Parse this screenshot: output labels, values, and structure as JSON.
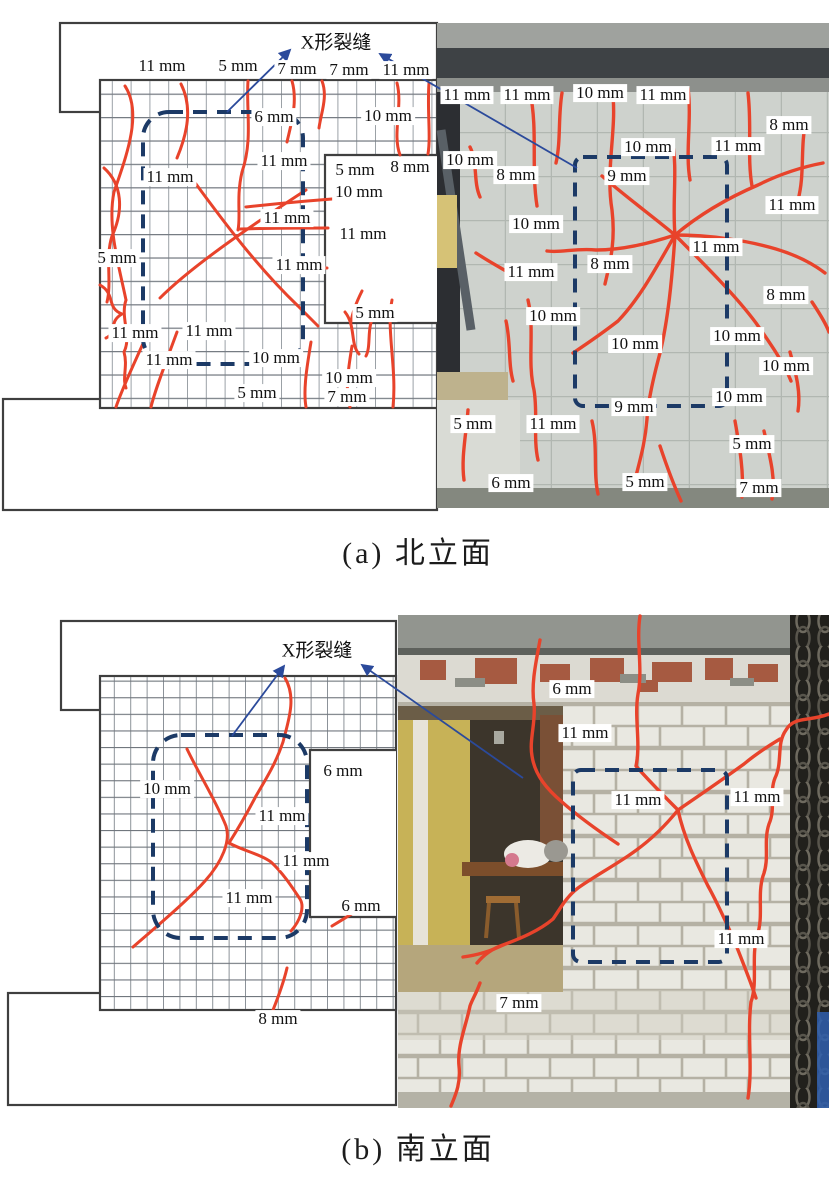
{
  "colors": {
    "crack": "#e8432b",
    "dashed_box": "#1c3a66",
    "arrow": "#2b4a9b",
    "outline": "#3f3f3f",
    "label_bg": "#ffffff",
    "label_text": "#111111"
  },
  "panels": [
    {
      "id": "a",
      "caption": "(a) 北立面",
      "xcrack_label": "X形裂缝",
      "diagram_labels": [
        {
          "text": "11 mm",
          "x": 162,
          "y": 66
        },
        {
          "text": "5 mm",
          "x": 238,
          "y": 66
        },
        {
          "text": "7 mm",
          "x": 297,
          "y": 69
        },
        {
          "text": "7 mm",
          "x": 349,
          "y": 70
        },
        {
          "text": "11 mm",
          "x": 406,
          "y": 70
        },
        {
          "text": "6 mm",
          "x": 274,
          "y": 117
        },
        {
          "text": "10 mm",
          "x": 388,
          "y": 116
        },
        {
          "text": "11 mm",
          "x": 284,
          "y": 161
        },
        {
          "text": "11 mm",
          "x": 170,
          "y": 177
        },
        {
          "text": "5 mm",
          "x": 355,
          "y": 170
        },
        {
          "text": "8 mm",
          "x": 410,
          "y": 167
        },
        {
          "text": "10 mm",
          "x": 359,
          "y": 192
        },
        {
          "text": "11 mm",
          "x": 287,
          "y": 218
        },
        {
          "text": "11 mm",
          "x": 363,
          "y": 234
        },
        {
          "text": "11 mm",
          "x": 299,
          "y": 265
        },
        {
          "text": "5 mm",
          "x": 117,
          "y": 258
        },
        {
          "text": "5 mm",
          "x": 375,
          "y": 313
        },
        {
          "text": "11 mm",
          "x": 135,
          "y": 333
        },
        {
          "text": "11 mm",
          "x": 209,
          "y": 331
        },
        {
          "text": "11 mm",
          "x": 169,
          "y": 360
        },
        {
          "text": "10 mm",
          "x": 276,
          "y": 358
        },
        {
          "text": "10 mm",
          "x": 349,
          "y": 378
        },
        {
          "text": "5 mm",
          "x": 257,
          "y": 393
        },
        {
          "text": "7 mm",
          "x": 347,
          "y": 397
        }
      ],
      "photo_labels": [
        {
          "text": "11 mm",
          "x": 467,
          "y": 95
        },
        {
          "text": "11 mm",
          "x": 527,
          "y": 95
        },
        {
          "text": "10 mm",
          "x": 600,
          "y": 93
        },
        {
          "text": "11 mm",
          "x": 663,
          "y": 95
        },
        {
          "text": "8 mm",
          "x": 789,
          "y": 125
        },
        {
          "text": "10 mm",
          "x": 648,
          "y": 147
        },
        {
          "text": "11 mm",
          "x": 738,
          "y": 146
        },
        {
          "text": "10 mm",
          "x": 470,
          "y": 160
        },
        {
          "text": "8 mm",
          "x": 516,
          "y": 175
        },
        {
          "text": "9 mm",
          "x": 627,
          "y": 176
        },
        {
          "text": "11 mm",
          "x": 792,
          "y": 205
        },
        {
          "text": "10 mm",
          "x": 536,
          "y": 224
        },
        {
          "text": "11 mm",
          "x": 716,
          "y": 247
        },
        {
          "text": "8 mm",
          "x": 610,
          "y": 264
        },
        {
          "text": "11 mm",
          "x": 531,
          "y": 272
        },
        {
          "text": "8 mm",
          "x": 786,
          "y": 295
        },
        {
          "text": "10 mm",
          "x": 553,
          "y": 316
        },
        {
          "text": "10 mm",
          "x": 737,
          "y": 336
        },
        {
          "text": "10 mm",
          "x": 635,
          "y": 344
        },
        {
          "text": "10 mm",
          "x": 786,
          "y": 366
        },
        {
          "text": "10 mm",
          "x": 739,
          "y": 397
        },
        {
          "text": "9 mm",
          "x": 634,
          "y": 407
        },
        {
          "text": "5 mm",
          "x": 473,
          "y": 424
        },
        {
          "text": "11 mm",
          "x": 553,
          "y": 424
        },
        {
          "text": "5 mm",
          "x": 752,
          "y": 444
        },
        {
          "text": "6 mm",
          "x": 511,
          "y": 483
        },
        {
          "text": "5 mm",
          "x": 645,
          "y": 482
        },
        {
          "text": "7 mm",
          "x": 759,
          "y": 488
        }
      ]
    },
    {
      "id": "b",
      "caption": "(b) 南立面",
      "xcrack_label": "X形裂缝",
      "diagram_labels": [
        {
          "text": "10 mm",
          "x": 167,
          "y": 789
        },
        {
          "text": "6 mm",
          "x": 343,
          "y": 771
        },
        {
          "text": "11 mm",
          "x": 282,
          "y": 816
        },
        {
          "text": "11 mm",
          "x": 306,
          "y": 861
        },
        {
          "text": "11 mm",
          "x": 249,
          "y": 898
        },
        {
          "text": "6 mm",
          "x": 361,
          "y": 906
        },
        {
          "text": "8 mm",
          "x": 278,
          "y": 1019
        }
      ],
      "photo_labels": [
        {
          "text": "6 mm",
          "x": 572,
          "y": 689
        },
        {
          "text": "11 mm",
          "x": 585,
          "y": 733
        },
        {
          "text": "11 mm",
          "x": 638,
          "y": 800
        },
        {
          "text": "11 mm",
          "x": 757,
          "y": 797
        },
        {
          "text": "11 mm",
          "x": 741,
          "y": 939
        },
        {
          "text": "7 mm",
          "x": 519,
          "y": 1003
        }
      ]
    }
  ]
}
